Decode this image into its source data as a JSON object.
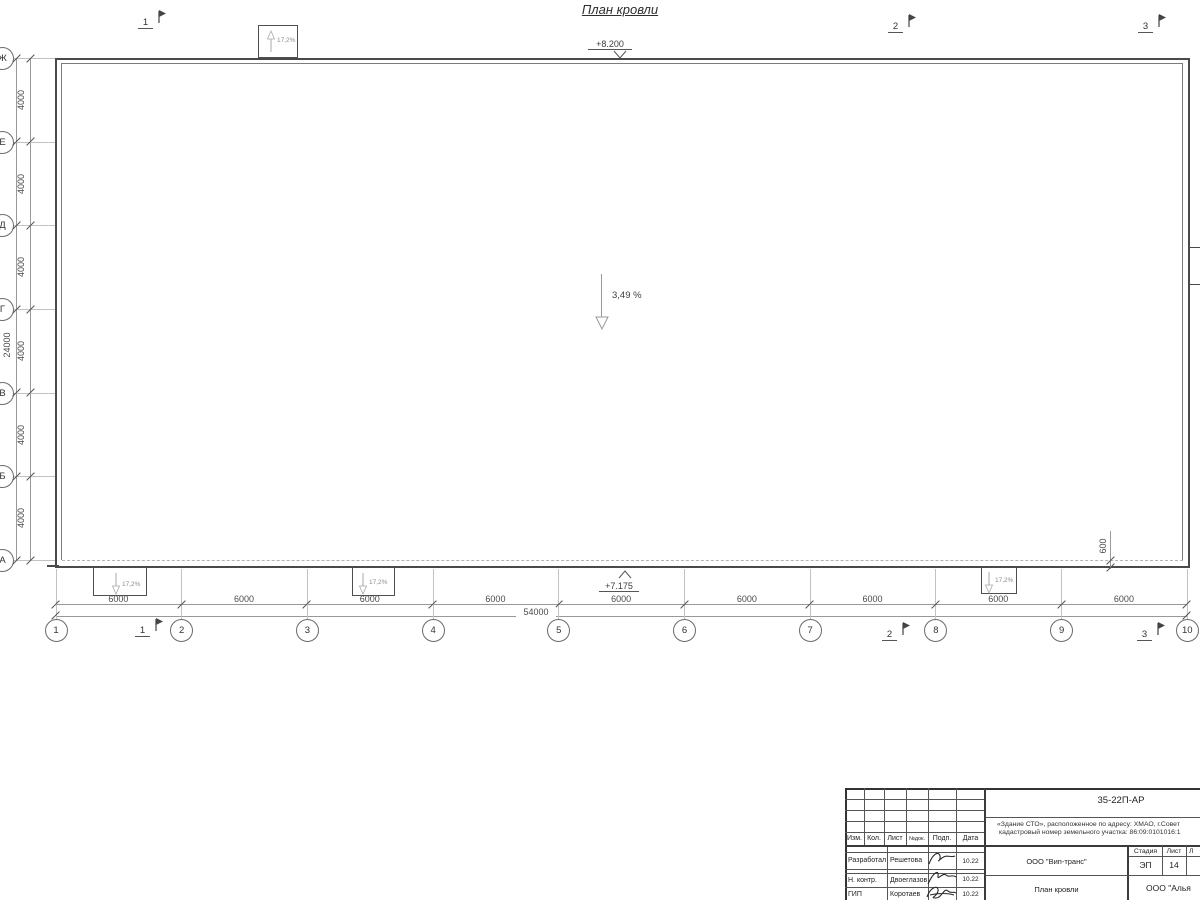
{
  "page_title": "План кровли",
  "drawing": {
    "elevation_top": "+8.200",
    "elevation_bottom": "+7.175",
    "slope_label": "3,49 %",
    "canopy_slope_label": "17,2%",
    "parapet_offset_label": "600",
    "grid": {
      "col_labels": [
        "1",
        "2",
        "3",
        "4",
        "5",
        "6",
        "7",
        "8",
        "9",
        "10"
      ],
      "row_labels_top_to_bottom": [
        "Ж",
        "Е",
        "Д",
        "Г",
        "В",
        "Б",
        "А"
      ],
      "col_bay_dim": "6000",
      "col_total_dim": "54000",
      "row_bay_dim": "4000",
      "row_total_dim": "24000"
    },
    "section_marks": [
      "1",
      "2",
      "3"
    ]
  },
  "titleblock": {
    "doc_number": "35-22П-АР",
    "project_line1": "«Здание СТО», расположенное по адресу: ХМАО, г.Совет",
    "project_line2": "кадастровый номер земельного участка: 86:09:0101016:1",
    "rev_header": {
      "izm": "Изм.",
      "kol": "Кол.",
      "list": "Лист",
      "ndok": "№док.",
      "podp": "Подп.",
      "data": "Дата"
    },
    "signature_rows": [
      {
        "role": "Разработал",
        "name": "Решетова",
        "date": "10.22"
      },
      {
        "role": "Н. контр.",
        "name": "Двоеглазов",
        "date": "10.22"
      },
      {
        "role": "ГИП",
        "name": "Коротаев",
        "date": "10.22"
      }
    ],
    "company": "ООО \"Вип-транс\"",
    "sheet_title": "План кровли",
    "stage_header": "Стадия",
    "sheet_header": "Лист",
    "sheets_header": "Л",
    "stage_value": "ЭП",
    "sheet_value": "14",
    "partner": "ООО \"Алья"
  }
}
